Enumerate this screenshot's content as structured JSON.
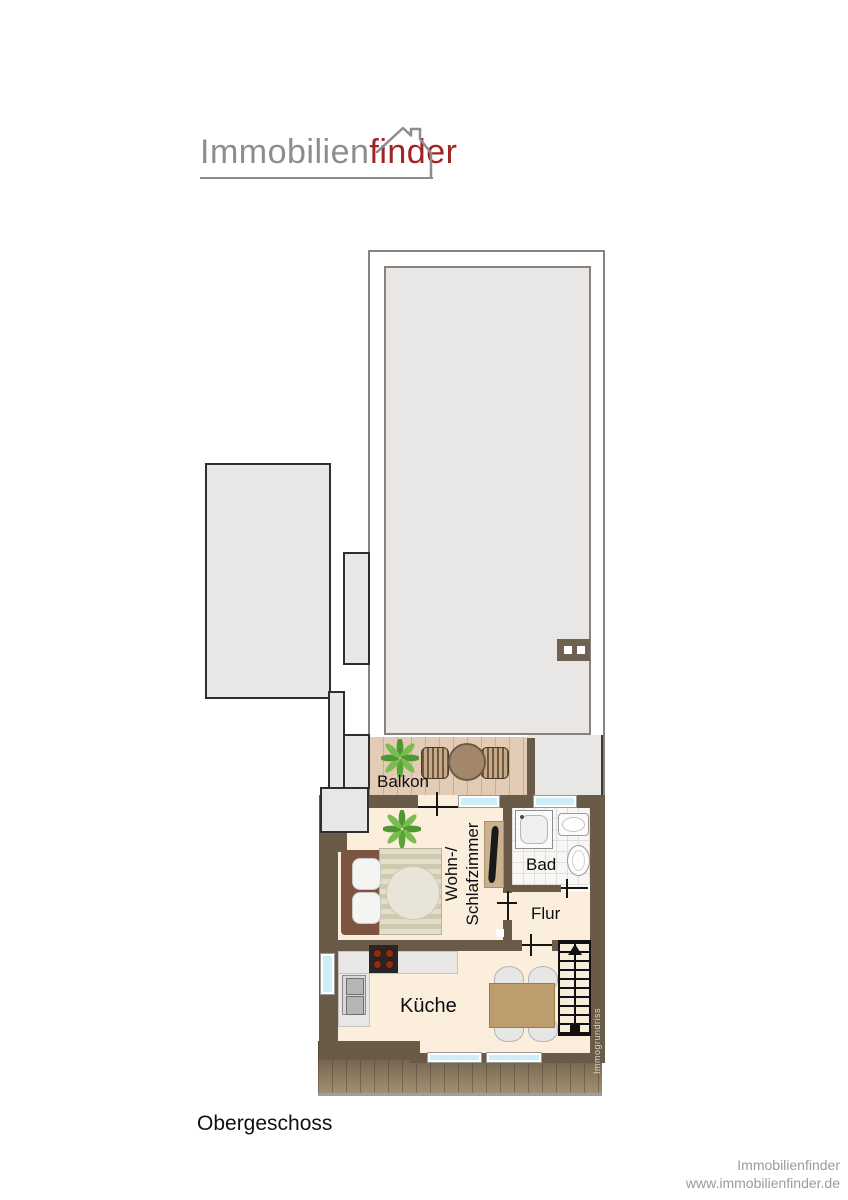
{
  "logo": {
    "text_gray": "Immobilien",
    "text_red": "finder",
    "house_icon": "house-outline-icon"
  },
  "plan": {
    "rooms": {
      "balkon": "Balkon",
      "wohn_line1": "Wohn-/",
      "wohn_line2": "Schlafzimmer",
      "bad": "Bad",
      "flur": "Flur",
      "kueche": "Küche"
    },
    "watermark": "Immogrundriss"
  },
  "floor_label": "Obergeschoss",
  "footer": {
    "company": "Immobilienfinder",
    "website": "www.immobilienfinder.de"
  },
  "colors": {
    "wall": "#6a5b49",
    "floor_cream": "#fbeedd",
    "balcony_wood": "#e2ccb5",
    "roof_gray": "#e8e7e5",
    "roof_border": "#8c8178",
    "window_glass": "#cdeef6",
    "logo_gray": "#8d8d8d",
    "logo_red": "#a32222",
    "deck_dark": "#5d4e3b",
    "deck_light": "#a39073",
    "footer_text": "#9b9b9b"
  }
}
